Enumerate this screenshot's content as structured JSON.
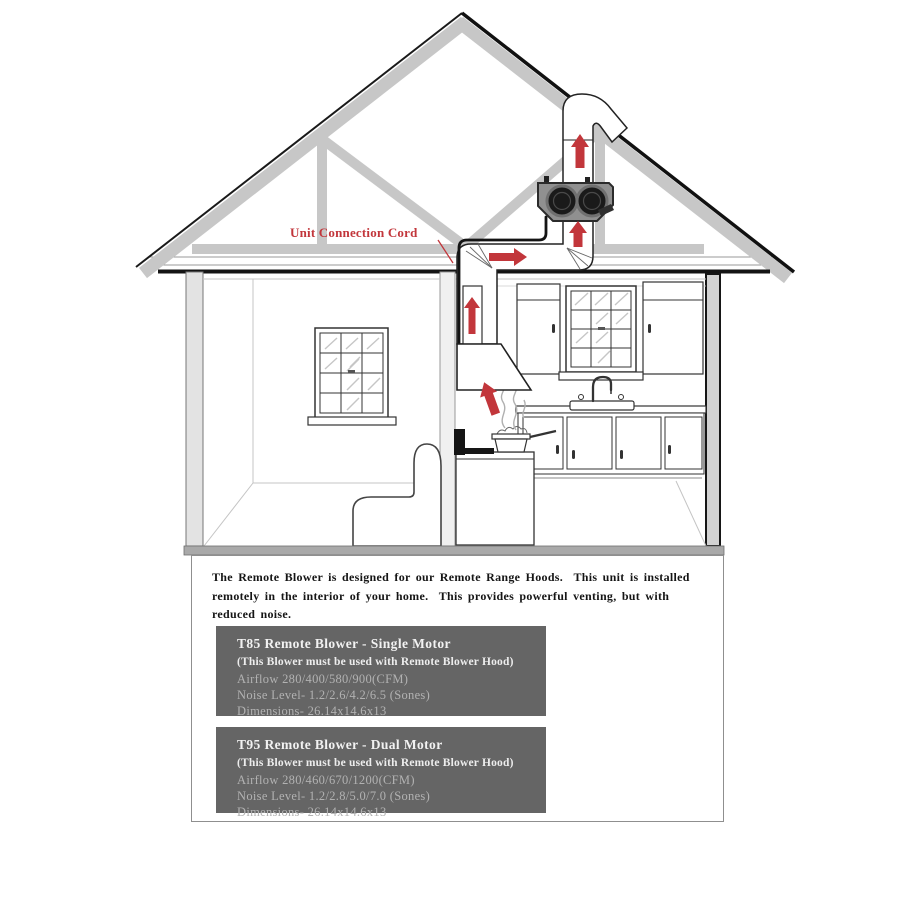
{
  "diagram": {
    "cord_label": "Unit Connection Cord"
  },
  "panel": {
    "description": "The Remote Blower is designed for our Remote Range Hoods.  This unit is installed\nremotely in the interior of your home.  This provides powerful venting, but with\nreduced noise.",
    "products": [
      {
        "title": "T85 Remote Blower - Single Motor",
        "note": "(This Blower must be used with Remote Blower Hood)",
        "airflow": "Airflow 280/400/580/900(CFM)",
        "noise_level": "Noise Level- 1.2/2.6/4.2/6.5 (Sones)",
        "dimensions": "Dimensions- 26.14x14.6x13"
      },
      {
        "title": "T95 Remote Blower - Dual Motor",
        "note": "(This Blower must be used with Remote Blower Hood)",
        "airflow": "Airflow 280/460/670/1200(CFM)",
        "noise_level": "Noise Level- 1.2/2.8/5.0/7.0 (Sones)",
        "dimensions": "Dimensions- 26.14x14.6x13"
      }
    ]
  },
  "colors": {
    "accent_red": "#c2363b",
    "spec_box_bg": "#656565",
    "spec_box_dim_text": "#b2b2b2",
    "truss_gray": "#c7c7c7",
    "blower_body_gray": "#909090"
  }
}
